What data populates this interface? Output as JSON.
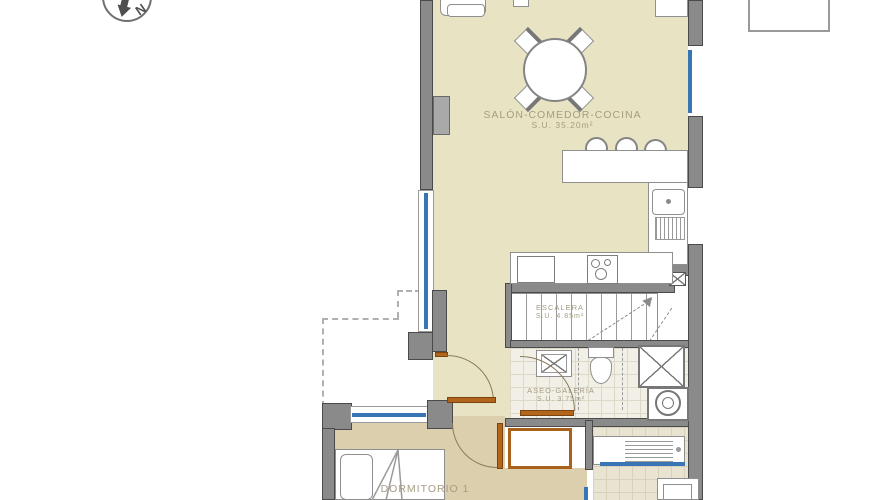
{
  "compass": {
    "label": "N"
  },
  "rooms": {
    "salon": {
      "label": "SALÓN-COMEDOR-COCINA",
      "area": "S.U. 35.20m²"
    },
    "escalera": {
      "label": "ESCALERA",
      "area": "S.U. 4.85m²"
    },
    "aseo": {
      "label": "ASEO-GALERÍA",
      "area": "S.U. 3.75m²"
    },
    "dormitorio": {
      "label": "DORMITORIO 1"
    }
  },
  "colors": {
    "floor_main": "#e8e4c3",
    "floor_bedroom": "#dbcfae",
    "wall": "#8a8a8a",
    "window_blue": "#3875b5",
    "door_orange": "#b2661c",
    "label_text": "#a59c82"
  },
  "fixtures": [
    "compass-rose",
    "dining-table",
    "dining-chairs",
    "armchair",
    "bar-counter",
    "bar-stools",
    "kitchen-sink",
    "drainboard",
    "hob",
    "fridge",
    "staircase",
    "stair-direction-arrow",
    "wash-basin",
    "toilet",
    "shower",
    "washing-machine",
    "wardrobe",
    "bed",
    "pillow",
    "laundry-counter",
    "windows",
    "door-arcs",
    "terrace-dashed-outline",
    "column-marker"
  ]
}
